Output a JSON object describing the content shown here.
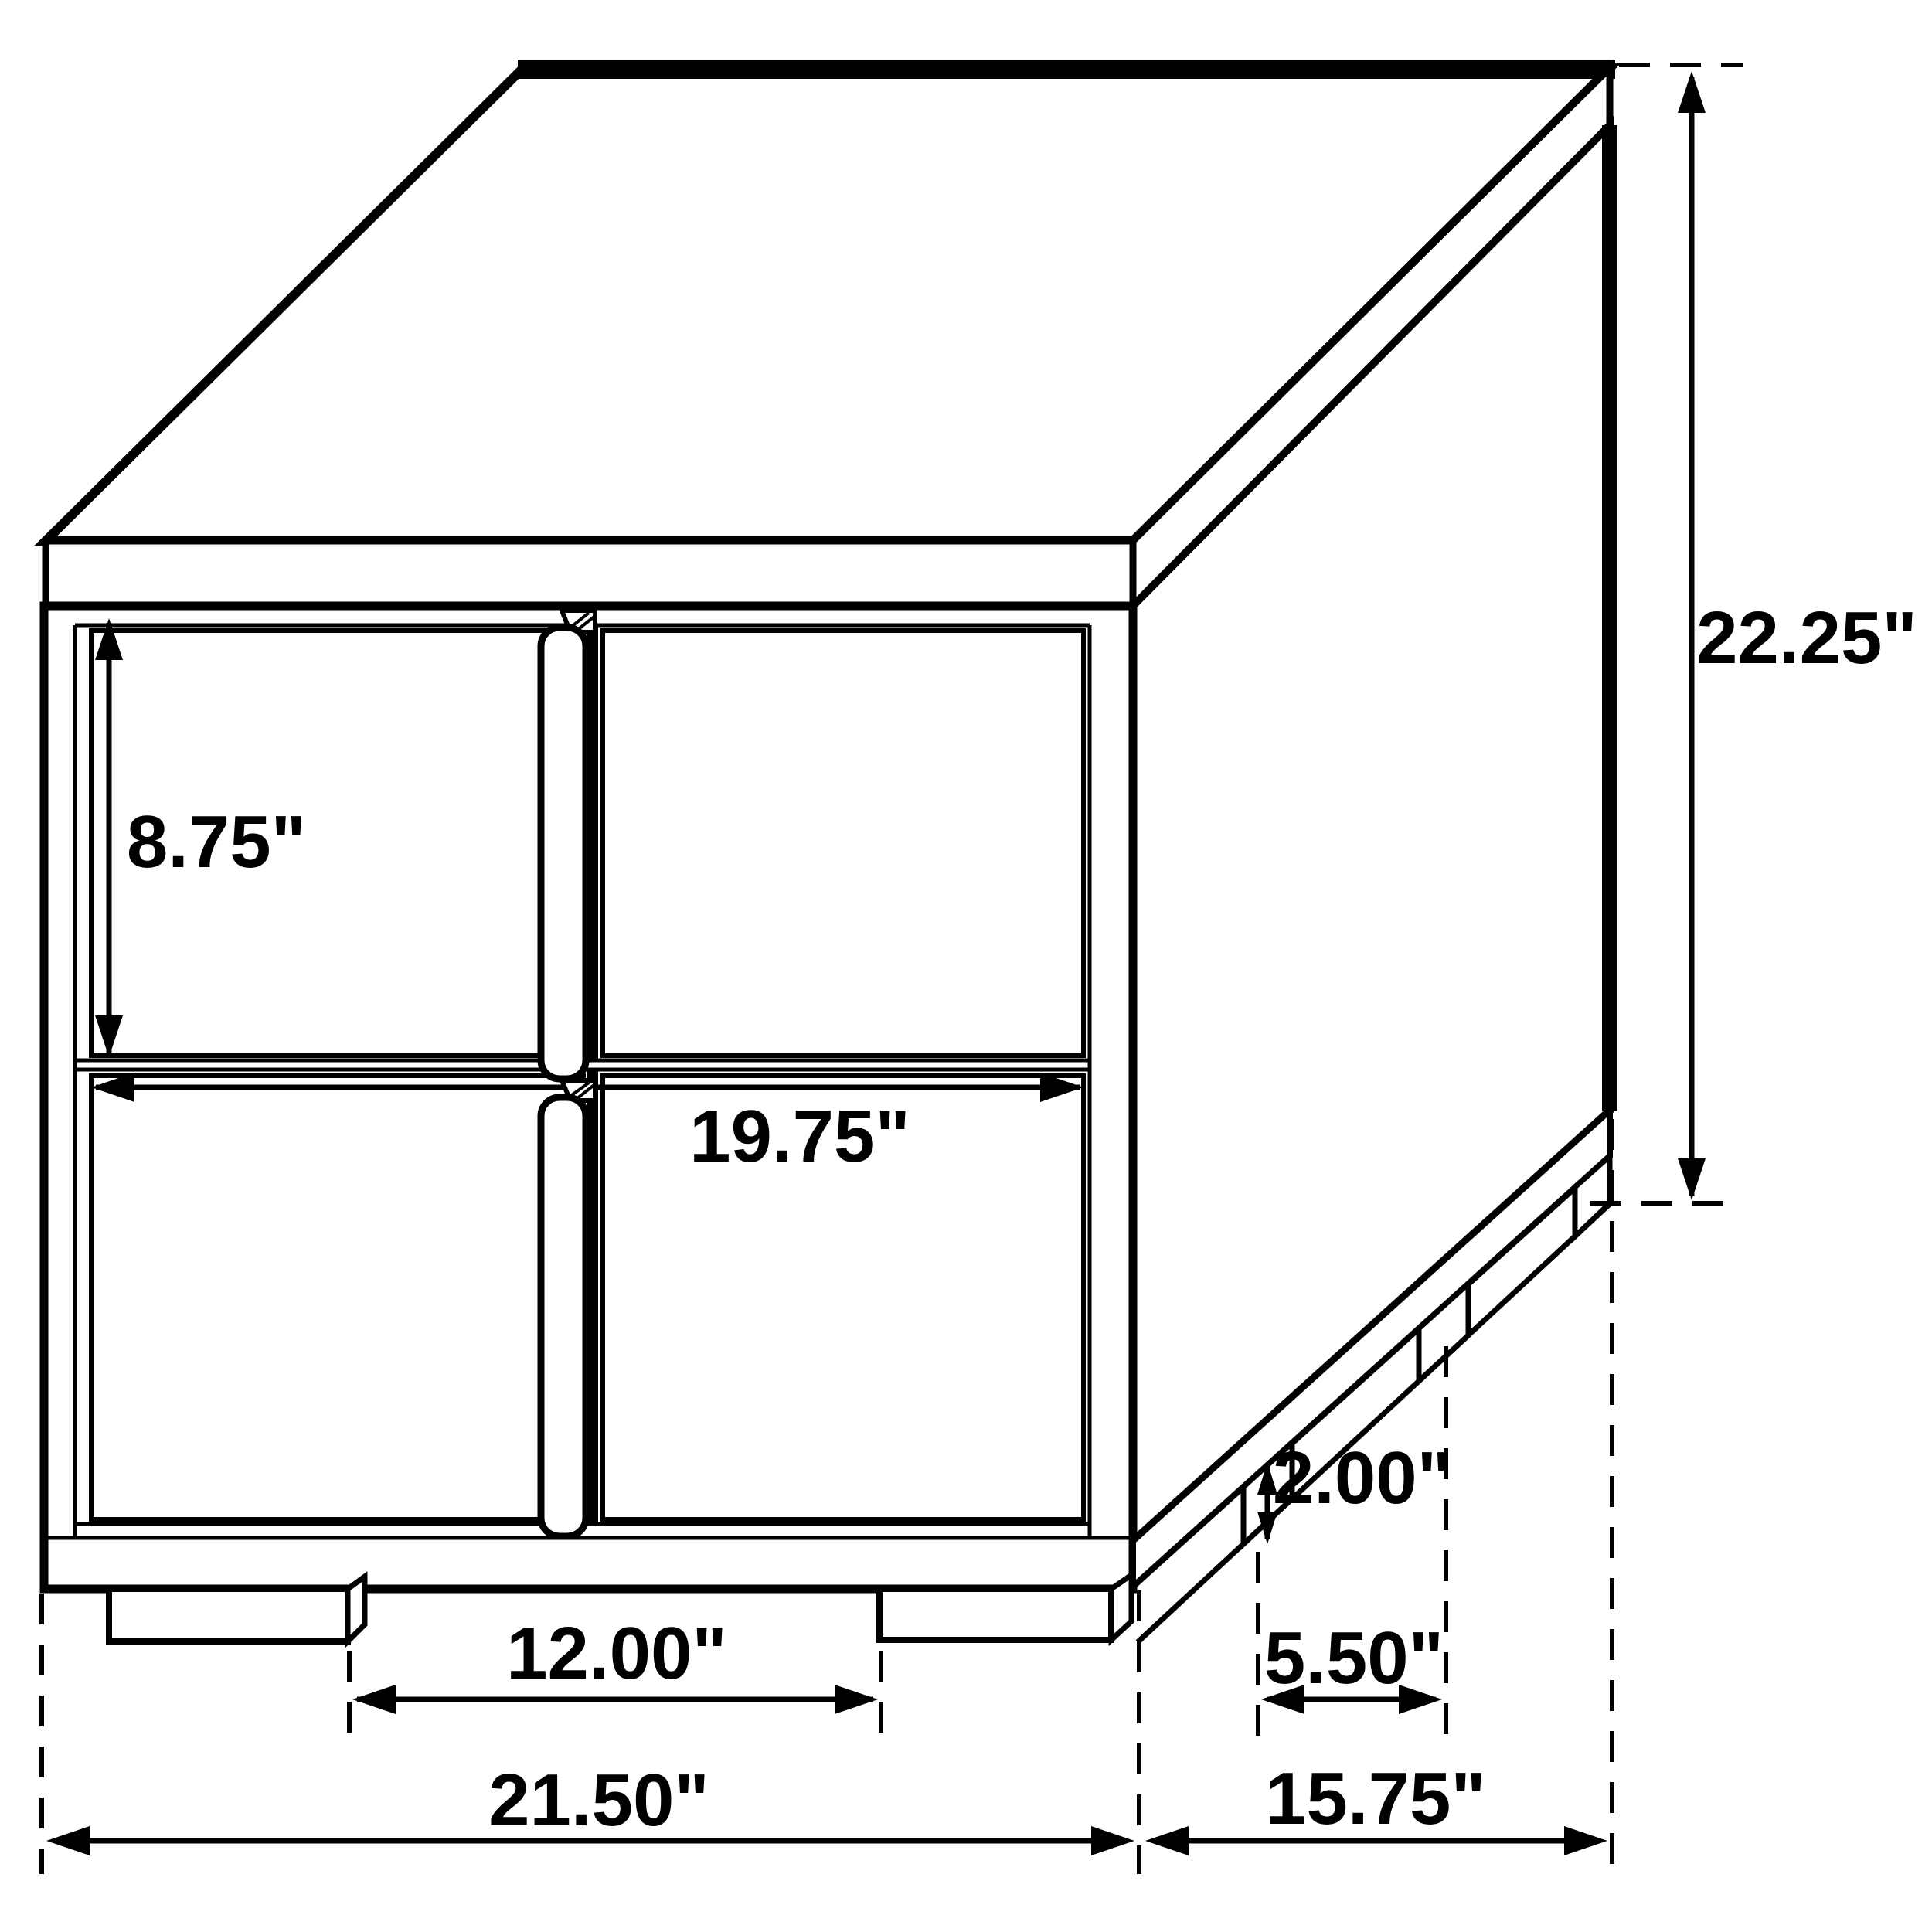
{
  "diagram": {
    "type": "furniture-dimension-drawing",
    "subject": "two-drawer nightstand, isometric line drawing",
    "colors": {
      "line": "#000000",
      "background": "#ffffff"
    }
  },
  "dims": {
    "drawer_height": "8.75\"",
    "drawer_width": "19.75\"",
    "overall_height": "22.25\"",
    "leg_height": "2.00\"",
    "side_leg_gap": "5.50\"",
    "front_leg_gap": "12.00\"",
    "overall_width": "21.50\"",
    "overall_depth": "15.75\""
  }
}
